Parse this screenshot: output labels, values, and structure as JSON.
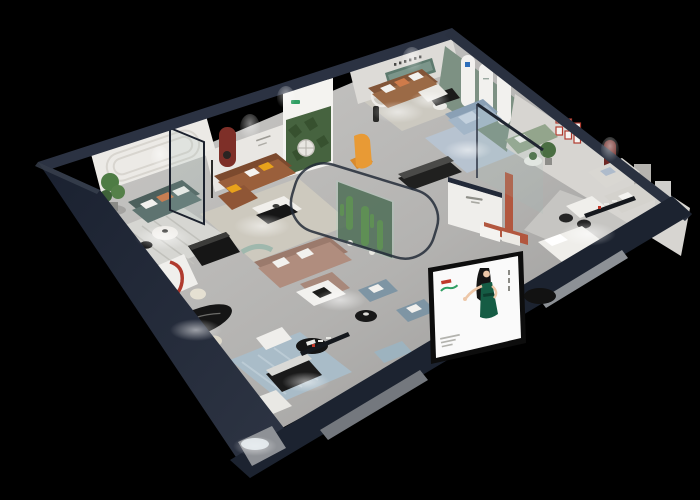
{
  "scene": {
    "title": "Isometric 3D cutaway render of a furniture showroom floor plan on a black background",
    "background": "#000000",
    "canvas": {
      "width": 700,
      "height": 500
    }
  },
  "palette": {
    "bg": "#000000",
    "shell_dark": "#1c2330",
    "shell_band": "#232a38",
    "shell_top": "#2b3242",
    "floor_light": "#c8c7c5",
    "floor_dark": "#9a9997",
    "wall_face": "#eceae6",
    "wall_face_dim": "#dddbd7",
    "green_arch_wall": "#7d9183",
    "forest_green": "#46633f",
    "sofa_teal": "#5e7370",
    "sofa_caramel": "#9a5f3b",
    "sofa_leather": "#9b6a46",
    "sofa_blue": "#a3b6c8",
    "sofa_sage": "#93a58c",
    "sofa_gray": "#d9d7d2",
    "sofa_taupe": "#b08d7e",
    "armchair_blue": "#7e95a4",
    "armchair_tan": "#b2754e",
    "accent_orange": "#e8a21b",
    "accent_terracotta": "#b2573f",
    "arch_red": "#7e2f28",
    "frame_red": "#b03a2e",
    "rug_stripe": "#d6d6d2",
    "rug_beige": "#cdc9be",
    "rug_blue": "#a9bcc8",
    "rug_steel": "#b7c3d0",
    "table_black": "#151515",
    "table_white": "#f1efeb",
    "bed_white": "#efeeea",
    "cacti_green": "#5f8f55",
    "terrarium_glass": "#2f4a33",
    "billboard_bg": "#fafafa",
    "billboard_dress": "#155c44",
    "billboard_logo_red": "#c0392b",
    "billboard_logo_green": "#2f9e63",
    "glass_tint": "rgba(160,195,188,0.16)",
    "plant_green": "#4e7c44"
  },
  "regions": {
    "rooms": [
      {
        "name": "left-lounge-teal-sofa"
      },
      {
        "name": "center-lounge-caramel-sofa"
      },
      {
        "name": "north-lounge-leather-sofa"
      },
      {
        "name": "arched-green-display-room"
      },
      {
        "name": "glass-partition-room"
      },
      {
        "name": "right-gallery-red-frames"
      },
      {
        "name": "bedroom-display"
      },
      {
        "name": "dining-display-black-oval-table"
      },
      {
        "name": "media-console-area"
      },
      {
        "name": "cactus-terrarium"
      },
      {
        "name": "billboard-facade"
      },
      {
        "name": "entrance-glow"
      }
    ]
  },
  "billboard": {
    "art": "illustrated woman with long black hair in a dark green dress",
    "background": "#fafafa",
    "logo_red": "#c0392b",
    "logo_green": "#2f9e63"
  }
}
